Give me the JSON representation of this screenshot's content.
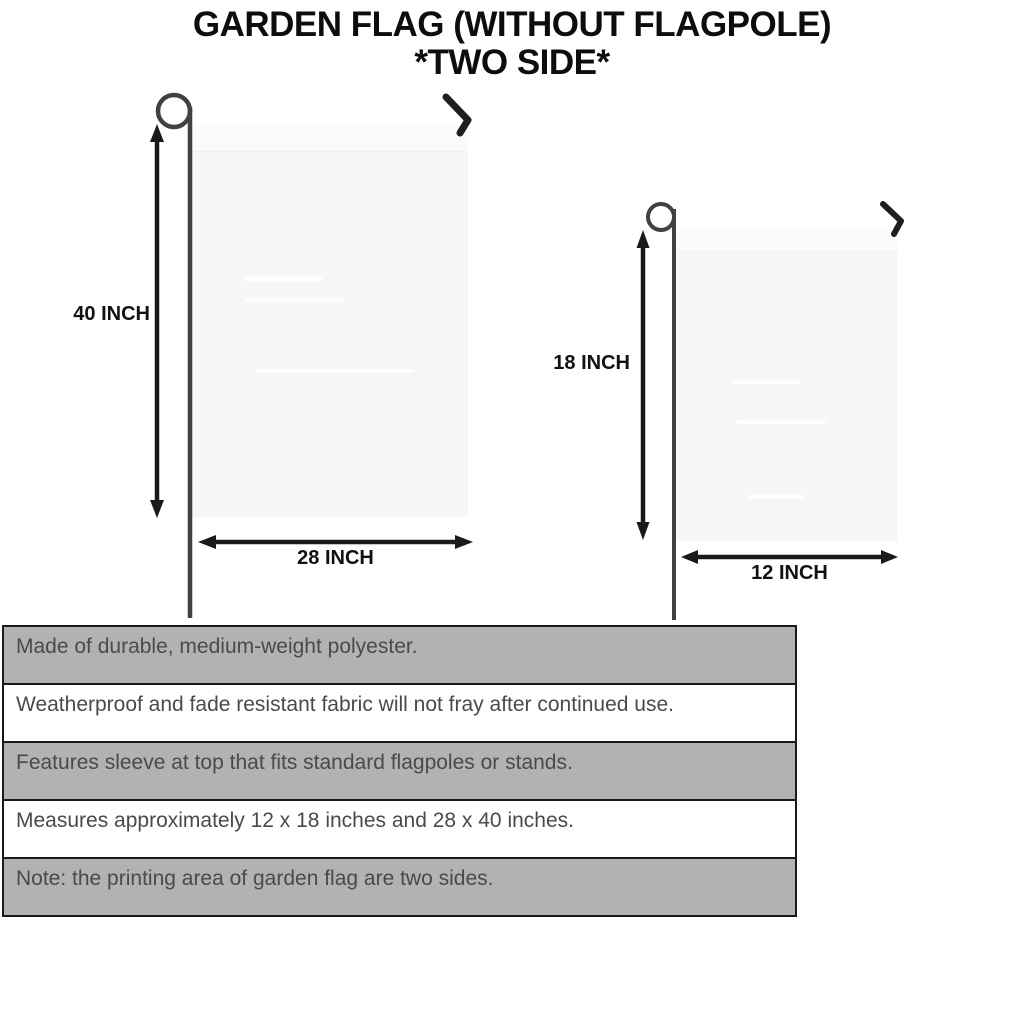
{
  "title": {
    "line1": "GARDEN FLAG (WITHOUT FLAGPOLE)",
    "line2": "*TWO SIDE*"
  },
  "flags": {
    "large": {
      "height_label": "40 INCH",
      "width_label": "28 INCH"
    },
    "small": {
      "height_label": "18 INCH",
      "width_label": "12 INCH"
    }
  },
  "features": [
    "Made of durable, medium-weight polyester.",
    "Weatherproof and fade resistant fabric will not fray after continued use.",
    "Features sleeve at top that fits standard flagpoles or stands.",
    "Measures approximately 12 x 18 inches and 28 x 40 inches.",
    "Note: the printing area of garden flag are two sides."
  ],
  "icons": {
    "pole_loop": "flagpole-loop-icon",
    "pole_hook": "flagpole-hook-icon",
    "dimension_arrow": "double-arrow-icon"
  },
  "colors": {
    "title_text": "#0d0d0d",
    "dimension_text": "#111111",
    "feature_text": "#4a4a4a",
    "row_shaded_bg": "#b2b2b2",
    "row_plain_bg": "#ffffff",
    "row_border": "#1a1a1a",
    "flag_fill": "#f6f6f5",
    "pole": "#414141",
    "arrow": "#1a1a1a"
  }
}
